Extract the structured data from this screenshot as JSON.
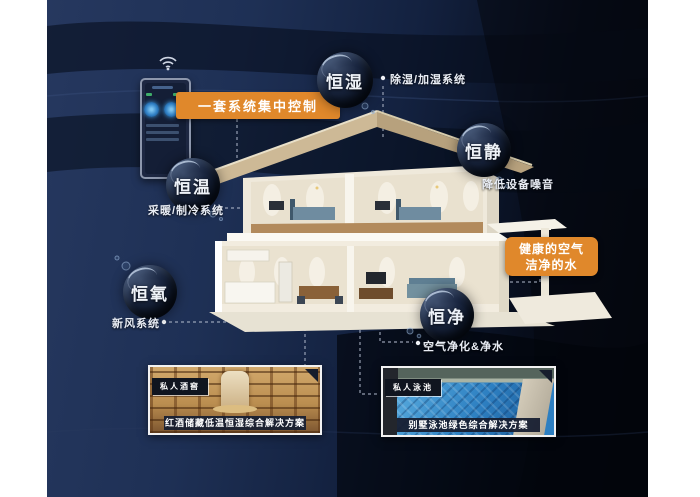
{
  "colors": {
    "accent_orange": "#e0882b",
    "background_navy": "#1e3055",
    "background_dark": "#04060d",
    "caption_bg": "#171f32",
    "bubble_text": "#eef2f8"
  },
  "control": {
    "label": "一套系统集中控制",
    "wifi_icon": "wifi-icon",
    "device": "smart-control-panel"
  },
  "bubbles": [
    {
      "id": "hengshi",
      "label": "恒湿",
      "callout": "除湿/加湿系统"
    },
    {
      "id": "hengjing",
      "label": "恒静",
      "callout": "降低设备噪音"
    },
    {
      "id": "hengwen",
      "label": "恒温",
      "callout": "采暖/制冷系统"
    },
    {
      "id": "hengyang",
      "label": "恒氧",
      "callout": "新风系统"
    },
    {
      "id": "hengjin",
      "label": "恒净",
      "callout": "空气净化&净水"
    }
  ],
  "highlight_box": {
    "line1": "健康的空气",
    "line2": "洁净的水"
  },
  "cards": [
    {
      "tag": "私人酒窖",
      "caption": "红酒储藏低温恒湿综合解决方案",
      "type": "wine-cellar-photo"
    },
    {
      "tag": "私人泳池",
      "caption": "别墅泳池绿色综合解决方案",
      "type": "pool-photo"
    }
  ]
}
